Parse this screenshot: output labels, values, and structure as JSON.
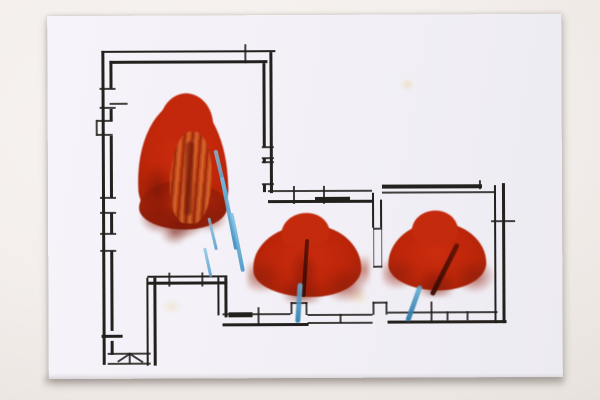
{
  "artwork": {
    "kind": "photograph of a hand-drawn architectural floor plan overpainted with red tree/flame shapes and blue crayon strokes",
    "rooms_visible": 3,
    "red_paint_masses": 3,
    "blue_crayon_strokes": 7,
    "paint_stains": 3,
    "text_content": ""
  },
  "colors": {
    "paper": "#f6f4fa",
    "ink": "#23201d",
    "red": "#c52a0d",
    "red-dark": "#96200b",
    "red-deep": "#6f1507",
    "orange": "#d4702e",
    "blue": "#5fb0da",
    "blue-dark": "#2f7fae",
    "stain": "#ecd9ad",
    "background": "#f3eeeb"
  }
}
